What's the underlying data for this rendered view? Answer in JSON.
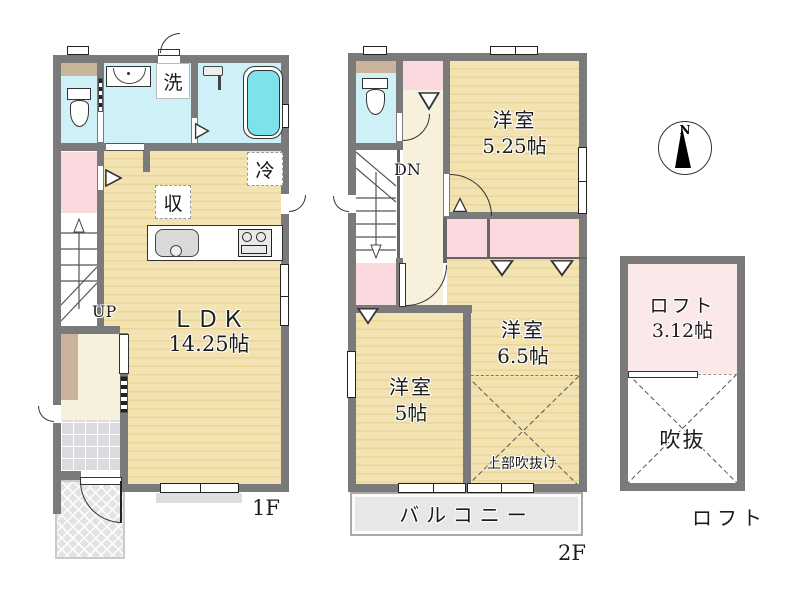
{
  "floor1": {
    "caption": "1F",
    "ldk_name": "ＬＤＫ",
    "ldk_size": "14.25帖",
    "laundry": "洗",
    "fridge": "冷",
    "storage": "収",
    "stairs_up": "UP"
  },
  "floor2": {
    "caption": "2F",
    "stairs_down": "DN",
    "room_a_name": "洋室",
    "room_a_size": "5.25帖",
    "room_b_name": "洋室",
    "room_b_size": "6.5帖",
    "room_c_name": "洋室",
    "room_c_size": "5帖",
    "void_above": "上部吹抜け",
    "balcony": "バルコニー"
  },
  "loft": {
    "caption": "ロフト",
    "name": "ロフト",
    "size": "3.12帖",
    "void": "吹抜"
  },
  "compass": {
    "north": "N"
  },
  "colors": {
    "wall": "#7a7a7a",
    "wood_floor": "#f3e2b2",
    "wet_room": "#cdf1f6",
    "closet_pink": "#fbd9de",
    "loft_pink": "#fbe8e8",
    "hall_cream": "#f7f0dd",
    "tub_cyan": "#7de2ea",
    "balcony_gray": "#e7e7ea",
    "shelf_tan": "#c9b39b"
  }
}
